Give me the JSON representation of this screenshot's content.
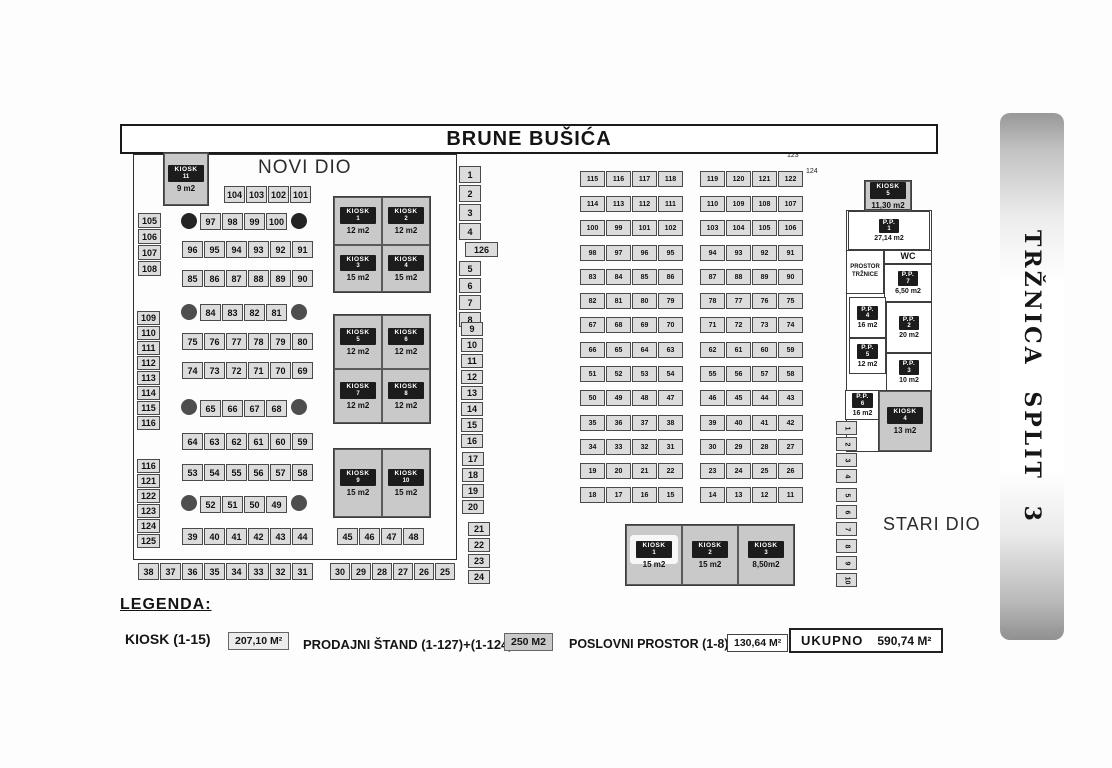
{
  "title": "BRUNE BUŠIĆA",
  "side_banner": "TRŽNICA SPLIT 3",
  "sections": {
    "novi": "NOVI DIO",
    "stari": "STARI DIO"
  },
  "ref_labels": [
    "123",
    "124"
  ],
  "legend": {
    "heading": "LEGENDA:",
    "items": [
      {
        "label": "KIOSK  (1-15)",
        "value": "207,10 M²"
      },
      {
        "label": "PRODAJNI ŠTAND (1-127)+(1-124)",
        "value": "250 M2"
      },
      {
        "label": "POSLOVNI PROSTOR (1-8)",
        "value": "130,64 M²"
      }
    ],
    "total": {
      "label": "UKUPNO",
      "value": "590,74 M²"
    }
  },
  "map": {
    "kiosk_word": "KIOSK",
    "pp_word": "P.P.",
    "strips": [
      {
        "x": 224,
        "y": 186,
        "cw": 21,
        "ch": 17,
        "fs": 9,
        "cells": [
          "104",
          "103",
          "102",
          "101"
        ]
      },
      {
        "x": 200,
        "y": 213,
        "cw": 21,
        "ch": 17,
        "fs": 9,
        "cells": [
          "97",
          "98",
          "99",
          "100"
        ]
      },
      {
        "x": 182,
        "y": 241,
        "cw": 21,
        "ch": 17,
        "fs": 9,
        "cells": [
          "96",
          "95",
          "94",
          "93",
          "92",
          "91"
        ]
      },
      {
        "x": 182,
        "y": 270,
        "cw": 21,
        "ch": 17,
        "fs": 9,
        "cells": [
          "85",
          "86",
          "87",
          "88",
          "89",
          "90"
        ]
      },
      {
        "x": 200,
        "y": 304,
        "cw": 21,
        "ch": 17,
        "fs": 9,
        "cells": [
          "84",
          "83",
          "82",
          "81"
        ]
      },
      {
        "x": 182,
        "y": 333,
        "cw": 21,
        "ch": 17,
        "fs": 9,
        "cells": [
          "75",
          "76",
          "77",
          "78",
          "79",
          "80"
        ]
      },
      {
        "x": 182,
        "y": 362,
        "cw": 21,
        "ch": 17,
        "fs": 9,
        "cells": [
          "74",
          "73",
          "72",
          "71",
          "70",
          "69"
        ]
      },
      {
        "x": 200,
        "y": 400,
        "cw": 21,
        "ch": 17,
        "fs": 9,
        "cells": [
          "65",
          "66",
          "67",
          "68"
        ]
      },
      {
        "x": 182,
        "y": 433,
        "cw": 21,
        "ch": 17,
        "fs": 9,
        "cells": [
          "64",
          "63",
          "62",
          "61",
          "60",
          "59"
        ]
      },
      {
        "x": 182,
        "y": 464,
        "cw": 21,
        "ch": 17,
        "fs": 9,
        "cells": [
          "53",
          "54",
          "55",
          "56",
          "57",
          "58"
        ]
      },
      {
        "x": 200,
        "y": 496,
        "cw": 21,
        "ch": 17,
        "fs": 9,
        "cells": [
          "52",
          "51",
          "50",
          "49"
        ]
      },
      {
        "x": 182,
        "y": 528,
        "cw": 21,
        "ch": 17,
        "fs": 9,
        "cells": [
          "39",
          "40",
          "41",
          "42",
          "43",
          "44"
        ]
      },
      {
        "x": 337,
        "y": 528,
        "cw": 21,
        "ch": 17,
        "fs": 9,
        "cells": [
          "45",
          "46",
          "47",
          "48"
        ]
      },
      {
        "x": 138,
        "y": 563,
        "cw": 21,
        "ch": 17,
        "fs": 9,
        "cells": [
          "38",
          "37",
          "36",
          "35",
          "34",
          "33",
          "32",
          "31"
        ]
      },
      {
        "x": 330,
        "y": 563,
        "cw": 20,
        "ch": 17,
        "fs": 9,
        "cells": [
          "30",
          "29",
          "28",
          "27",
          "26",
          "25"
        ]
      },
      {
        "x": 138,
        "y": 213,
        "o": "v",
        "cw": 23,
        "ch": 15,
        "fs": 9,
        "cells": [
          "105",
          "106",
          "107",
          "108"
        ]
      },
      {
        "x": 137,
        "y": 311,
        "o": "v",
        "cw": 23,
        "ch": 14,
        "fs": 9,
        "cells": [
          "109",
          "110",
          "111",
          "112",
          "113",
          "114",
          "115",
          "116"
        ]
      },
      {
        "x": 137,
        "y": 459,
        "o": "v",
        "cw": 23,
        "ch": 14,
        "fs": 9,
        "cells": [
          "116",
          "121",
          "122",
          "123",
          "124",
          "125"
        ]
      },
      {
        "x": 459,
        "y": 166,
        "o": "v",
        "cw": 22,
        "ch": 17,
        "gap": 2,
        "fs": 9,
        "cells": [
          "1",
          "2",
          "3",
          "4"
        ]
      },
      {
        "x": 465,
        "y": 242,
        "cw": 33,
        "ch": 15,
        "fs": 9,
        "cells": [
          "126"
        ]
      },
      {
        "x": 459,
        "y": 261,
        "o": "v",
        "cw": 22,
        "ch": 15,
        "gap": 2,
        "fs": 9,
        "cells": [
          "5",
          "6",
          "7",
          "8"
        ]
      },
      {
        "x": 461,
        "y": 322,
        "o": "v",
        "cw": 22,
        "ch": 14,
        "gap": 2,
        "fs": 9,
        "cells": [
          "9",
          "10",
          "11",
          "12",
          "13",
          "14",
          "15",
          "16"
        ]
      },
      {
        "x": 462,
        "y": 452,
        "o": "v",
        "cw": 22,
        "ch": 14,
        "gap": 2,
        "fs": 9,
        "cells": [
          "17",
          "18",
          "19",
          "20"
        ]
      },
      {
        "x": 468,
        "y": 522,
        "o": "v",
        "cw": 22,
        "ch": 14,
        "gap": 2,
        "fs": 9,
        "cells": [
          "21",
          "22",
          "23",
          "24"
        ]
      },
      {
        "x": 580,
        "y": 171,
        "cw": 25,
        "ch": 16,
        "fs": 7,
        "cells": [
          "115",
          "116",
          "117",
          "118"
        ]
      },
      {
        "x": 580,
        "y": 196,
        "cw": 25,
        "ch": 16,
        "fs": 7,
        "cells": [
          "114",
          "113",
          "112",
          "111"
        ]
      },
      {
        "x": 580,
        "y": 220,
        "cw": 25,
        "ch": 16,
        "fs": 7,
        "cells": [
          "100",
          "99",
          "101",
          "102"
        ]
      },
      {
        "x": 580,
        "y": 245,
        "cw": 25,
        "ch": 16,
        "fs": 7,
        "cells": [
          "98",
          "97",
          "96",
          "95"
        ]
      },
      {
        "x": 580,
        "y": 269,
        "cw": 25,
        "ch": 16,
        "fs": 7,
        "cells": [
          "83",
          "84",
          "85",
          "86"
        ]
      },
      {
        "x": 580,
        "y": 293,
        "cw": 25,
        "ch": 16,
        "fs": 7,
        "cells": [
          "82",
          "81",
          "80",
          "79"
        ]
      },
      {
        "x": 580,
        "y": 317,
        "cw": 25,
        "ch": 16,
        "fs": 7,
        "cells": [
          "67",
          "68",
          "69",
          "70"
        ]
      },
      {
        "x": 580,
        "y": 342,
        "cw": 25,
        "ch": 16,
        "fs": 7,
        "cells": [
          "66",
          "65",
          "64",
          "63"
        ]
      },
      {
        "x": 580,
        "y": 366,
        "cw": 25,
        "ch": 16,
        "fs": 7,
        "cells": [
          "51",
          "52",
          "53",
          "54"
        ]
      },
      {
        "x": 580,
        "y": 390,
        "cw": 25,
        "ch": 16,
        "fs": 7,
        "cells": [
          "50",
          "49",
          "48",
          "47"
        ]
      },
      {
        "x": 580,
        "y": 415,
        "cw": 25,
        "ch": 16,
        "fs": 7,
        "cells": [
          "35",
          "36",
          "37",
          "38"
        ]
      },
      {
        "x": 580,
        "y": 439,
        "cw": 25,
        "ch": 16,
        "fs": 7,
        "cells": [
          "34",
          "33",
          "32",
          "31"
        ]
      },
      {
        "x": 580,
        "y": 463,
        "cw": 25,
        "ch": 16,
        "fs": 7,
        "cells": [
          "19",
          "20",
          "21",
          "22"
        ]
      },
      {
        "x": 580,
        "y": 487,
        "cw": 25,
        "ch": 16,
        "fs": 7,
        "cells": [
          "18",
          "17",
          "16",
          "15"
        ]
      },
      {
        "x": 700,
        "y": 171,
        "cw": 25,
        "ch": 16,
        "fs": 7,
        "cells": [
          "119",
          "120",
          "121",
          "122"
        ]
      },
      {
        "x": 700,
        "y": 196,
        "cw": 25,
        "ch": 16,
        "fs": 7,
        "cells": [
          "110",
          "109",
          "108",
          "107"
        ]
      },
      {
        "x": 700,
        "y": 220,
        "cw": 25,
        "ch": 16,
        "fs": 7,
        "cells": [
          "103",
          "104",
          "105",
          "106"
        ]
      },
      {
        "x": 700,
        "y": 245,
        "cw": 25,
        "ch": 16,
        "fs": 7,
        "cells": [
          "94",
          "93",
          "92",
          "91"
        ]
      },
      {
        "x": 700,
        "y": 269,
        "cw": 25,
        "ch": 16,
        "fs": 7,
        "cells": [
          "87",
          "88",
          "89",
          "90"
        ]
      },
      {
        "x": 700,
        "y": 293,
        "cw": 25,
        "ch": 16,
        "fs": 7,
        "cells": [
          "78",
          "77",
          "76",
          "75"
        ]
      },
      {
        "x": 700,
        "y": 317,
        "cw": 25,
        "ch": 16,
        "fs": 7,
        "cells": [
          "71",
          "72",
          "73",
          "74"
        ]
      },
      {
        "x": 700,
        "y": 342,
        "cw": 25,
        "ch": 16,
        "fs": 7,
        "cells": [
          "62",
          "61",
          "60",
          "59"
        ]
      },
      {
        "x": 700,
        "y": 366,
        "cw": 25,
        "ch": 16,
        "fs": 7,
        "cells": [
          "55",
          "56",
          "57",
          "58"
        ]
      },
      {
        "x": 700,
        "y": 390,
        "cw": 25,
        "ch": 16,
        "fs": 7,
        "cells": [
          "46",
          "45",
          "44",
          "43"
        ]
      },
      {
        "x": 700,
        "y": 415,
        "cw": 25,
        "ch": 16,
        "fs": 7,
        "cells": [
          "39",
          "40",
          "41",
          "42"
        ]
      },
      {
        "x": 700,
        "y": 439,
        "cw": 25,
        "ch": 16,
        "fs": 7,
        "cells": [
          "30",
          "29",
          "28",
          "27"
        ]
      },
      {
        "x": 700,
        "y": 463,
        "cw": 25,
        "ch": 16,
        "fs": 7,
        "cells": [
          "23",
          "24",
          "25",
          "26"
        ]
      },
      {
        "x": 700,
        "y": 487,
        "cw": 25,
        "ch": 16,
        "fs": 7,
        "cells": [
          "14",
          "13",
          "12",
          "11"
        ]
      }
    ],
    "circles": [
      {
        "x": 181,
        "y": 213,
        "d": 16,
        "shade": "dark"
      },
      {
        "x": 291,
        "y": 213,
        "d": 16,
        "shade": "dark"
      },
      {
        "x": 181,
        "y": 304,
        "d": 16,
        "shade": "mid"
      },
      {
        "x": 291,
        "y": 304,
        "d": 16,
        "shade": "mid"
      },
      {
        "x": 181,
        "y": 399,
        "d": 16,
        "shade": "mid"
      },
      {
        "x": 291,
        "y": 399,
        "d": 16,
        "shade": "mid"
      },
      {
        "x": 181,
        "y": 495,
        "d": 16,
        "shade": "mid"
      },
      {
        "x": 291,
        "y": 495,
        "d": 16,
        "shade": "mid"
      }
    ],
    "kiosk_blocks": [
      {
        "x": 333,
        "y": 196,
        "w": 98,
        "h": 97,
        "cols": 2,
        "cells": [
          {
            "n": "1",
            "a": "12 m2"
          },
          {
            "n": "2",
            "a": "12 m2"
          },
          {
            "n": "3",
            "a": "15 m2"
          },
          {
            "n": "4",
            "a": "15 m2"
          }
        ]
      },
      {
        "x": 333,
        "y": 314,
        "w": 98,
        "h": 110,
        "cols": 2,
        "cells": [
          {
            "n": "5",
            "a": "12 m2"
          },
          {
            "n": "6",
            "a": "12 m2"
          },
          {
            "n": "7",
            "a": "12 m2"
          },
          {
            "n": "8",
            "a": "12 m2"
          }
        ]
      },
      {
        "x": 333,
        "y": 448,
        "w": 98,
        "h": 70,
        "cols": 2,
        "cells": [
          {
            "n": "9",
            "a": "15 m2"
          },
          {
            "n": "10",
            "a": "15 m2"
          }
        ]
      },
      {
        "x": 625,
        "y": 524,
        "w": 170,
        "h": 62,
        "cols": 3,
        "cells": [
          {
            "n": "1",
            "a": "15 m2",
            "hl": true
          },
          {
            "n": "2",
            "a": "15 m2"
          },
          {
            "n": "3",
            "a": "8,50m2"
          }
        ]
      },
      {
        "x": 163,
        "y": 152,
        "w": 46,
        "h": 54,
        "cols": 1,
        "cells": [
          {
            "n": "11",
            "a": "9 m2"
          }
        ]
      },
      {
        "x": 864,
        "y": 180,
        "w": 48,
        "h": 30,
        "cols": 1,
        "cells": [
          {
            "n": "5",
            "a": "11,30 m2"
          }
        ]
      },
      {
        "x": 878,
        "y": 390,
        "w": 54,
        "h": 62,
        "cols": 1,
        "cells": [
          {
            "n": "4",
            "a": "13 m2"
          }
        ]
      }
    ],
    "pp_boxes": [
      {
        "type": "outline",
        "x": 846,
        "y": 210,
        "w": 86,
        "h": 242,
        "name": "poslovni-prostor-outline"
      },
      {
        "type": "pp",
        "x": 848,
        "y": 211,
        "w": 82,
        "h": 39,
        "n": "1",
        "area": "27,14 m2"
      },
      {
        "type": "label",
        "x": 884,
        "y": 250,
        "w": 48,
        "h": 14,
        "fs": 9,
        "text": "WC",
        "name": "wc-box"
      },
      {
        "type": "label",
        "x": 846,
        "y": 250,
        "w": 38,
        "h": 44,
        "fs": 6,
        "text": "PROSTOR\nTRŽNICE",
        "name": "prostor-trznice-box"
      },
      {
        "type": "pp",
        "x": 884,
        "y": 264,
        "w": 48,
        "h": 38,
        "n": "7",
        "area": "6,50 m2"
      },
      {
        "type": "pp",
        "x": 849,
        "y": 297,
        "w": 37,
        "h": 41,
        "n": "4",
        "area": "16 m2"
      },
      {
        "type": "pp",
        "x": 886,
        "y": 302,
        "w": 46,
        "h": 51,
        "n": "2",
        "area": "20 m2"
      },
      {
        "type": "pp",
        "x": 849,
        "y": 338,
        "w": 37,
        "h": 36,
        "n": "5",
        "area": "12 m2"
      },
      {
        "type": "pp",
        "x": 886,
        "y": 353,
        "w": 46,
        "h": 38,
        "n": "3",
        "area": "10 m2"
      },
      {
        "type": "pp",
        "x": 845,
        "y": 390,
        "w": 35,
        "h": 30,
        "n": "6",
        "area": "16 m2"
      }
    ],
    "side_stacks": [
      {
        "x": 836,
        "y": 421,
        "cw": 21,
        "ch": 14,
        "gap": 2,
        "cells": [
          "1",
          "2",
          "3",
          "4"
        ]
      },
      {
        "x": 836,
        "y": 488,
        "cw": 21,
        "ch": 14,
        "gap": 3,
        "cells": [
          "5",
          "6",
          "7",
          "8",
          "9",
          "10"
        ]
      }
    ]
  }
}
